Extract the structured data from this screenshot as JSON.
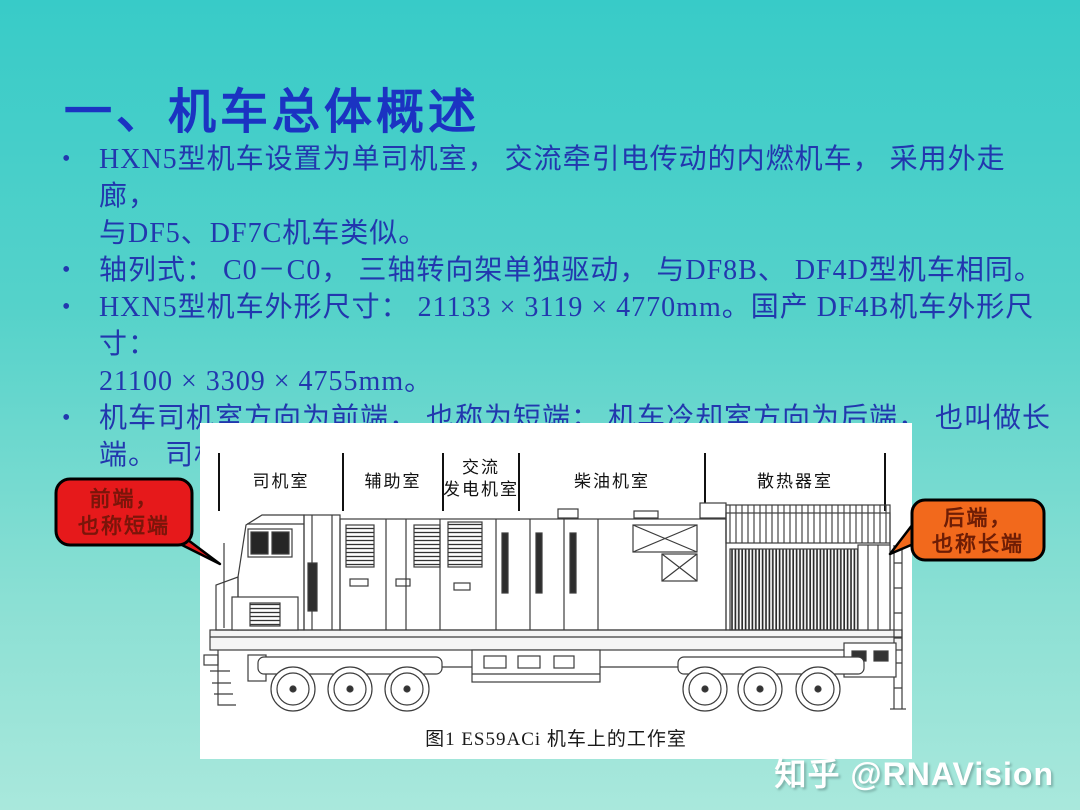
{
  "slide": {
    "title": "一、机车总体概述",
    "bullet_char": "•",
    "bullets": [
      {
        "lines": [
          "HXN5型机车设置为单司机室， 交流牵引电传动的内燃机车， 采用外走廊，",
          "与DF5、DF7C机车类似。"
        ]
      },
      {
        "lines": [
          "轴列式： C0－C0， 三轴转向架单独驱动， 与DF8B、 DF4D型机车相同。"
        ]
      },
      {
        "lines": [
          "HXN5型机车外形尺寸： 21133 × 3119 × 4770mm。国产 DF4B机车外形尺寸：",
          "21100 × 3309 × 4755mm。"
        ]
      },
      {
        "lines": [
          "机车司机室方向为前端， 也称为短端； 机车冷却室方向为后端， 也叫做长",
          "端。 司机侧称为B侧（左侧）,副司机侧称为A侧（右侧）。"
        ]
      }
    ]
  },
  "figure": {
    "caption": "图1  ES59ACi 机车上的工作室",
    "compartments": [
      {
        "label": "司机室"
      },
      {
        "label": "辅助室"
      },
      {
        "label": "交流",
        "label2": "发电机室"
      },
      {
        "label": "柴油机室"
      },
      {
        "label": "散热器室"
      }
    ]
  },
  "callouts": {
    "front": {
      "line1": "前端，",
      "line2": "也称短端"
    },
    "rear": {
      "line1": "后端，",
      "line2": "也称长端"
    }
  },
  "watermark": {
    "text": "知乎 @RNAVision"
  },
  "colors": {
    "background_top": "#38cbc8",
    "background_bottom": "#a9e8dc",
    "title": "#1b33c2",
    "body_text": "#2237ae",
    "front_callout_fill": "#e6191b",
    "rear_callout_fill": "#f2691c",
    "front_callout_text": "#7b150a",
    "rear_callout_text": "#6e1d05"
  }
}
